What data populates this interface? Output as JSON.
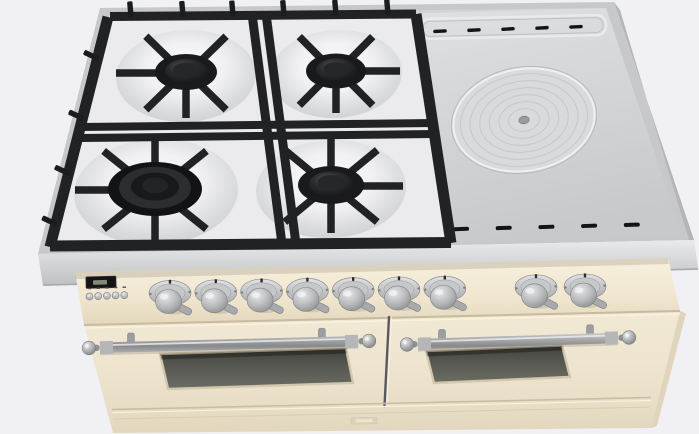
{
  "scene": {
    "type": "3d-product-render",
    "subject": "freestanding dual-fuel range cooker seen from the top front",
    "notes": "cream antique-white body, stainless cooktop, black cast-iron grates; no readable text in the image"
  },
  "colors": {
    "background": "#f1f1f5",
    "cooktop_steel": "#d2d3d5",
    "cooktop_rim": "#c7c8ca",
    "griddle": "#d7d8da",
    "enamel": "#ebebed",
    "grate_black": "#212225",
    "burner_black": "#1a1b1d",
    "slot_black": "#141416",
    "panel_cream": "#f3ead6",
    "door_cream": "#eee4cf",
    "trim_cream_shadow": "#c9bea3",
    "knob_metal": "#b7b8ba",
    "handle_metal": "#a4a5a7",
    "oven_glass": "#55564f",
    "display_bg": "#141416",
    "display_glow": "#9a9b8b"
  },
  "cooktop": {
    "sections": [
      "gas-burner-area",
      "solid-griddle-plate"
    ],
    "burners": [
      {
        "name": "burner-back-left",
        "size": "medium"
      },
      {
        "name": "burner-back-right",
        "size": "medium"
      },
      {
        "name": "burner-front-left",
        "size": "large-triple-ring"
      },
      {
        "name": "burner-front-right",
        "size": "medium"
      }
    ],
    "grate_material": "black cast iron",
    "griddle": {
      "name": "simmer-plate",
      "rings": 6
    },
    "vent_slots_back": 5,
    "vent_slots_front": 5
  },
  "control_panel": {
    "display": {
      "name": "clock-display",
      "text": ""
    },
    "buttons_count": 5,
    "knob_groups": [
      7,
      2
    ],
    "knobs_total": 9
  },
  "ovens": {
    "doors": 2,
    "handles": 2,
    "windows": 2,
    "badge": {
      "name": "brand-badge",
      "text": ""
    }
  }
}
